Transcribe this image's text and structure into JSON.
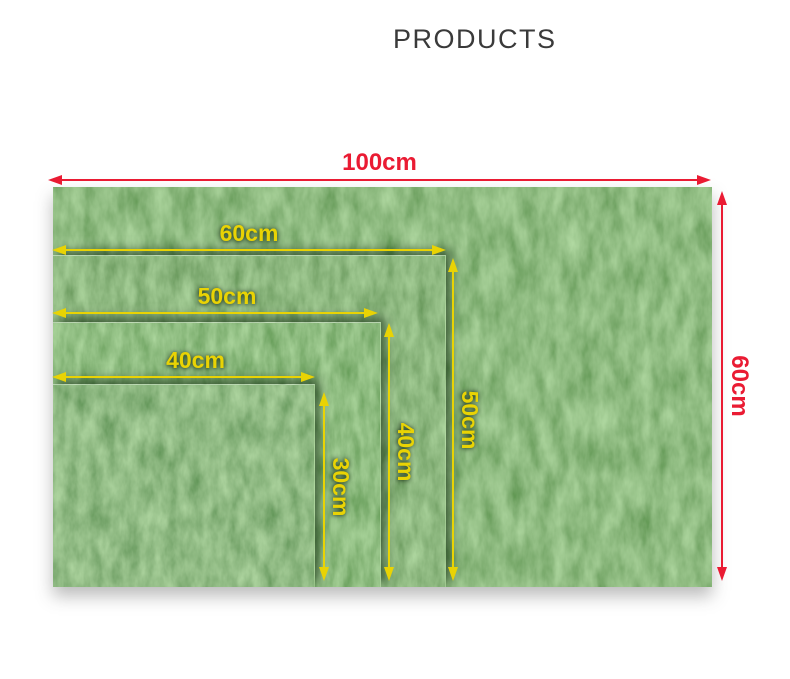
{
  "title": "PRODUCTS",
  "colors": {
    "dimension_red": "#ea1b33",
    "dimension_yellow": "#e9d304",
    "title_text": "#3a3a3a",
    "grass_green": "#4b823b",
    "background": "#ffffff"
  },
  "dimensions": {
    "outer": {
      "width": "100cm",
      "height": "60cm"
    },
    "size60": {
      "width": "60cm",
      "height": "50cm"
    },
    "size50": {
      "width": "50cm",
      "height": "40cm"
    },
    "size40": {
      "width": "40cm",
      "height": "30cm"
    }
  }
}
